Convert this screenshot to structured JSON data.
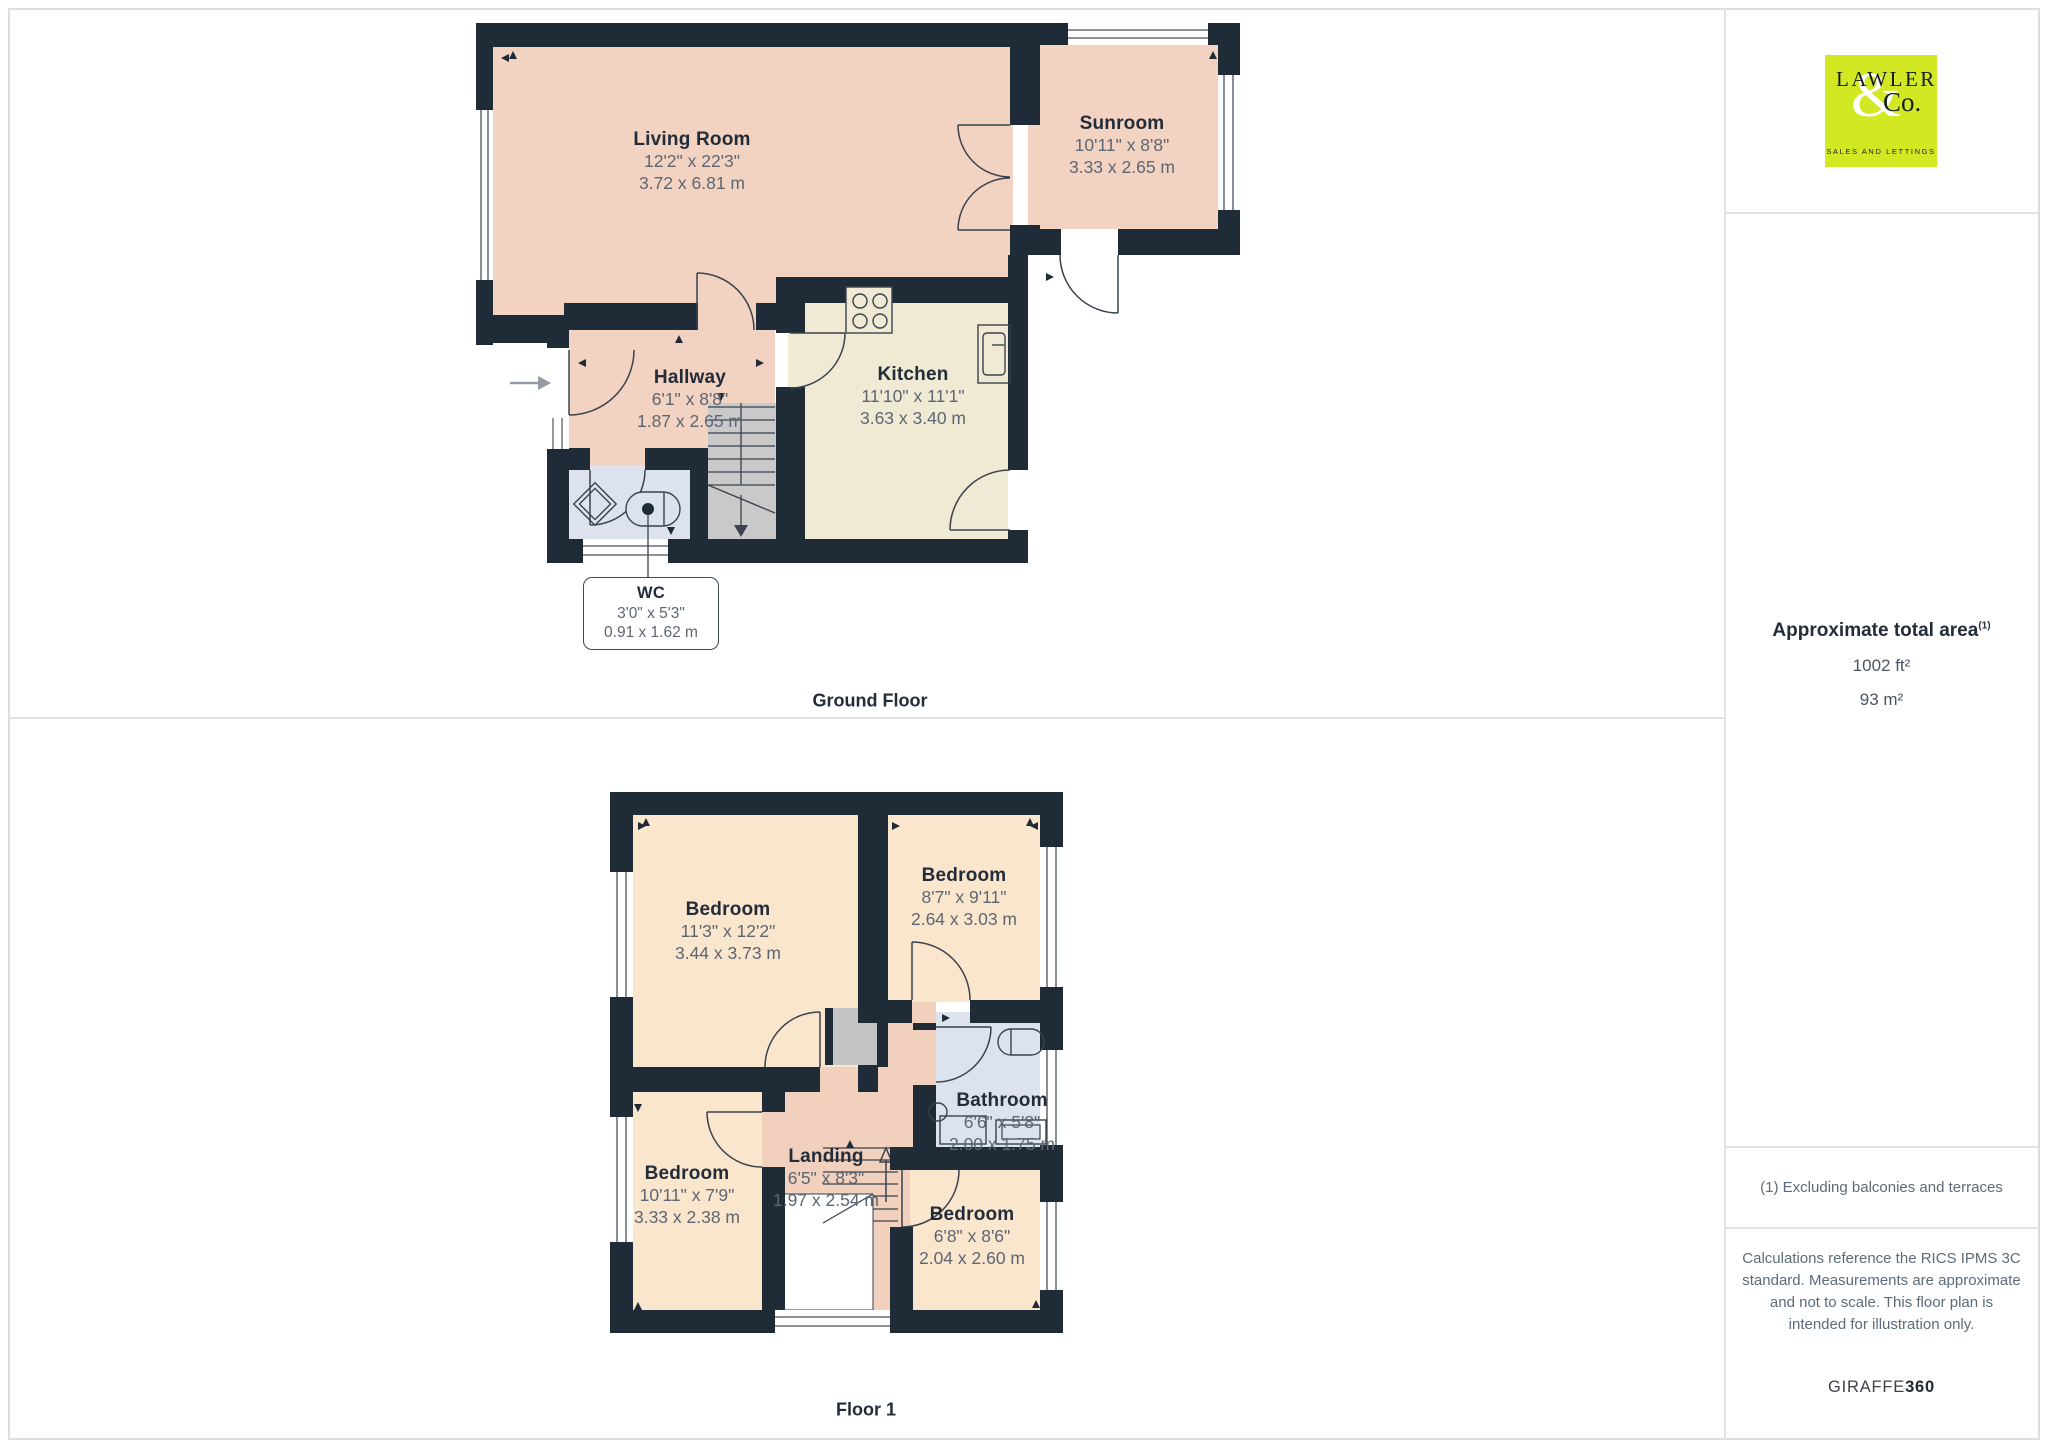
{
  "ground_floor": {
    "section_label": "Ground Floor",
    "rooms": {
      "living_room": {
        "name": "Living Room",
        "dims_imperial": "12'2\" x 22'3\"",
        "dims_metric": "3.72 x 6.81 m"
      },
      "sunroom": {
        "name": "Sunroom",
        "dims_imperial": "10'11\" x 8'8\"",
        "dims_metric": "3.33 x 2.65 m"
      },
      "hallway": {
        "name": "Hallway",
        "dims_imperial": "6'1\" x 8'8\"",
        "dims_metric": "1.87 x 2.65 m"
      },
      "kitchen": {
        "name": "Kitchen",
        "dims_imperial": "11'10\" x 11'1\"",
        "dims_metric": "3.63 x 3.40 m"
      },
      "wc": {
        "name": "WC",
        "dims_imperial": "3'0\" x 5'3\"",
        "dims_metric": "0.91 x 1.62 m"
      }
    }
  },
  "floor_1": {
    "section_label": "Floor 1",
    "rooms": {
      "bedroom_top_left": {
        "name": "Bedroom",
        "dims_imperial": "11'3\" x 12'2\"",
        "dims_metric": "3.44 x 3.73 m"
      },
      "bedroom_top_right": {
        "name": "Bedroom",
        "dims_imperial": "8'7\" x 9'11\"",
        "dims_metric": "2.64 x 3.03 m"
      },
      "bathroom": {
        "name": "Bathroom",
        "dims_imperial": "6'6\" x 5'8\"",
        "dims_metric": "2.00 x 1.75 m"
      },
      "bedroom_bottom_left": {
        "name": "Bedroom",
        "dims_imperial": "10'11\" x 7'9\"",
        "dims_metric": "3.33 x 2.38 m"
      },
      "landing": {
        "name": "Landing",
        "dims_imperial": "6'5\" x 8'3\"",
        "dims_metric": "1.97 x 2.54 m"
      },
      "bedroom_bottom_right": {
        "name": "Bedroom",
        "dims_imperial": "6'8\" x 8'6\"",
        "dims_metric": "2.04 x 2.60 m"
      }
    }
  },
  "sidebar": {
    "logo": {
      "line1": "LAWLER",
      "ampersand": "&",
      "line2": "Co.",
      "tagline": "SALES AND LETTINGS"
    },
    "area": {
      "title": "Approximate total area",
      "footnote_marker": "(1)",
      "value_imperial": "1002 ft²",
      "value_metric": "93 m²"
    },
    "footnote": "(1) Excluding balconies and terraces",
    "disclaimer": "Calculations reference the RICS IPMS 3C standard. Measurements are approximate and not to scale. This floor plan is intended for illustration only.",
    "brand": {
      "name": "GIRAFFE",
      "suffix": "360"
    }
  },
  "colors": {
    "wall": "#202b38",
    "room_salmon": "#f2d2c0",
    "room_peach": "#fae5cd",
    "room_cream": "#f0e9d3",
    "room_blue": "#dce2ee",
    "stairs_gray": "#c9c9c9",
    "logo_lime": "#d2e823",
    "label_dark": "#232d3a",
    "label_gray": "#5d6673"
  }
}
